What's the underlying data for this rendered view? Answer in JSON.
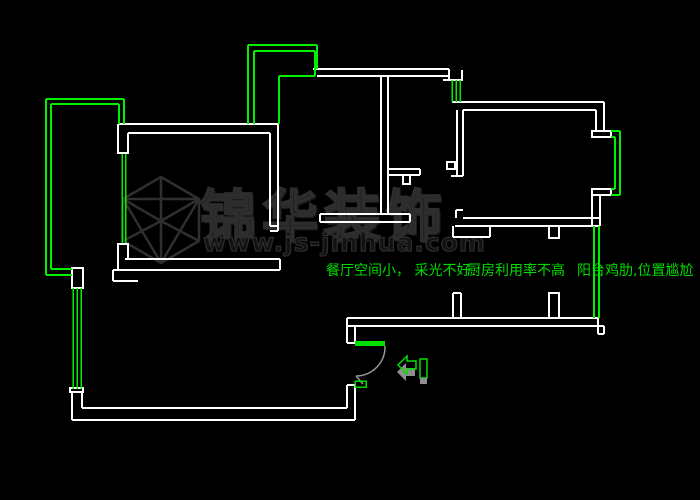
{
  "canvas": {
    "width": 700,
    "height": 500,
    "background": "#000000"
  },
  "colors": {
    "wall": "#ffffff",
    "window_line": "#00f000",
    "annotation_text": "#00dd00",
    "door_leaf": "#00e000",
    "door_arc": "#999999",
    "arrow_shadow": "#8f8f8f",
    "watermark": "#2d2d2d"
  },
  "annotations": {
    "dining": "餐厅空间小， 采光不好",
    "kitchen": "厨房利用率不高",
    "balcony": "阳台鸡肋,位置尴尬"
  },
  "watermark": {
    "brand": "锦华装饰",
    "url": "www.js-jinhua.com",
    "logo": "isometric-cube-logo"
  },
  "entry_marker": {
    "icon": "entry-direction-left-arrow"
  }
}
